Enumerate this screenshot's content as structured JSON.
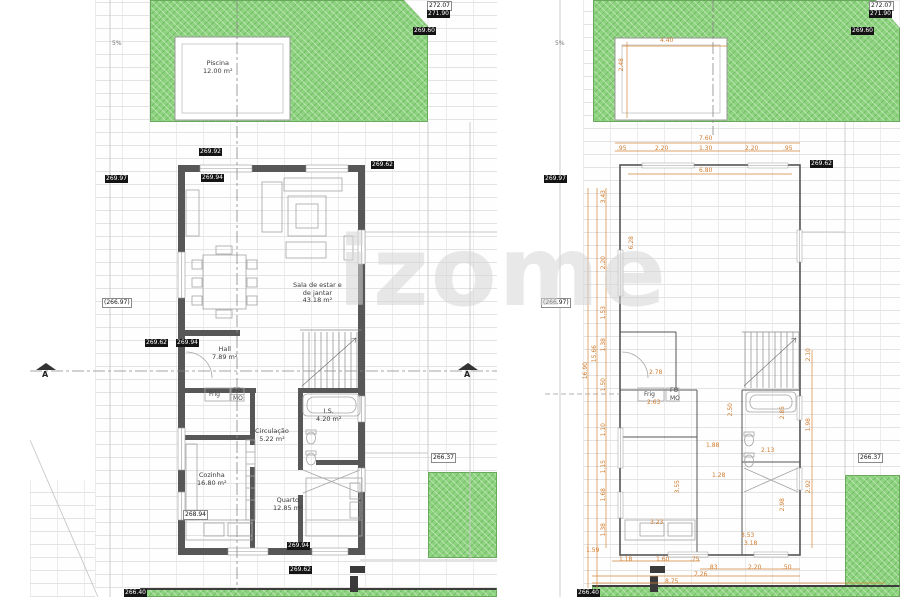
{
  "watermark": "izome",
  "colors": {
    "grass": "#8ed37f",
    "dimension": "#d07c2e",
    "wall": "#575757"
  },
  "section_marker": {
    "label": "A"
  },
  "slope_markers": [
    {
      "text": "5%",
      "x": 112,
      "y": 40
    },
    {
      "text": "5%",
      "x": 555,
      "y": 40
    }
  ],
  "left_plan": {
    "rooms": [
      {
        "text": "Piscina\n12.00 m²",
        "x": 203,
        "y": 60
      },
      {
        "text": "Sala de estar e\nde jantar\n43.18 m²",
        "x": 293,
        "y": 282
      },
      {
        "text": "Hall\n7.89 m²",
        "x": 212,
        "y": 346
      },
      {
        "text": "I.S.\n4.20 m²",
        "x": 316,
        "y": 408
      },
      {
        "text": "Circulação\n5.22 m²",
        "x": 255,
        "y": 428
      },
      {
        "text": "Cozinha\n16.80 m²",
        "x": 197,
        "y": 472
      },
      {
        "text": "Quarto\n12.85 m²",
        "x": 273,
        "y": 497
      }
    ],
    "appliances": [
      {
        "text": "Frig",
        "x": 209,
        "y": 391
      },
      {
        "text": "FO",
        "x": 233,
        "y": 387
      },
      {
        "text": "MO",
        "x": 233,
        "y": 395
      }
    ],
    "levels": [
      {
        "text": "272.07",
        "cls": "light",
        "x": 427,
        "y": 1
      },
      {
        "text": "271.90",
        "cls": "dark",
        "x": 427,
        "y": 10
      },
      {
        "text": "269.60",
        "cls": "dark",
        "x": 413,
        "y": 27
      },
      {
        "text": "269.92",
        "cls": "dark",
        "x": 199,
        "y": 148
      },
      {
        "text": "269.62",
        "cls": "dark",
        "x": 371,
        "y": 161
      },
      {
        "text": "269.94",
        "cls": "dark",
        "x": 201,
        "y": 174
      },
      {
        "text": "269.97",
        "cls": "dark",
        "x": 105,
        "y": 175
      },
      {
        "text": "(266.97)",
        "cls": "light",
        "x": 102,
        "y": 298
      },
      {
        "text": "269.62",
        "cls": "dark",
        "x": 145,
        "y": 339
      },
      {
        "text": "269.94",
        "cls": "dark",
        "x": 176,
        "y": 339
      },
      {
        "text": "268.94",
        "cls": "light",
        "x": 183,
        "y": 510
      },
      {
        "text": "266.37",
        "cls": "light",
        "x": 431,
        "y": 453
      },
      {
        "text": "269.94",
        "cls": "dark",
        "x": 287,
        "y": 542
      },
      {
        "text": "269.62",
        "cls": "dark",
        "x": 289,
        "y": 566
      },
      {
        "text": "266.40",
        "cls": "dark",
        "x": 124,
        "y": 589
      }
    ]
  },
  "right_plan": {
    "appliances": [
      {
        "text": "Frig",
        "x": 644,
        "y": 391
      },
      {
        "text": "FO",
        "x": 670,
        "y": 387
      },
      {
        "text": "MO",
        "x": 670,
        "y": 395
      }
    ],
    "levels": [
      {
        "text": "272.07",
        "cls": "light",
        "x": 869,
        "y": 1
      },
      {
        "text": "271.90",
        "cls": "dark",
        "x": 869,
        "y": 10
      },
      {
        "text": "269.60",
        "cls": "dark",
        "x": 851,
        "y": 27
      },
      {
        "text": "269.62",
        "cls": "dark",
        "x": 810,
        "y": 160
      },
      {
        "text": "269.97",
        "cls": "dark",
        "x": 544,
        "y": 175
      },
      {
        "text": "(266.97)",
        "cls": "light",
        "x": 541,
        "y": 298
      },
      {
        "text": "266.37",
        "cls": "light",
        "x": 858,
        "y": 453
      },
      {
        "text": "266.40",
        "cls": "dark",
        "x": 577,
        "y": 589
      }
    ],
    "dimensions": [
      {
        "text": "4.40",
        "x": 660,
        "y": 38
      },
      {
        "text": "2.48",
        "x": 619,
        "y": 58,
        "cls": "vrot"
      },
      {
        "text": "7.60",
        "x": 699,
        "y": 136
      },
      {
        "text": ".95",
        "x": 617,
        "y": 146
      },
      {
        "text": "2.20",
        "x": 655,
        "y": 146
      },
      {
        "text": "1.30",
        "x": 699,
        "y": 146
      },
      {
        "text": "2.20",
        "x": 745,
        "y": 146
      },
      {
        "text": ".95",
        "x": 783,
        "y": 146
      },
      {
        "text": "6.80",
        "x": 699,
        "y": 168
      },
      {
        "text": "3.43",
        "x": 601,
        "y": 190,
        "cls": "vrot"
      },
      {
        "text": "2.20",
        "x": 601,
        "y": 256,
        "cls": "vrot"
      },
      {
        "text": "1.53",
        "x": 601,
        "y": 306,
        "cls": "vrot"
      },
      {
        "text": "1.38",
        "x": 601,
        "y": 338,
        "cls": "vrot"
      },
      {
        "text": "1.50",
        "x": 601,
        "y": 378,
        "cls": "vrot"
      },
      {
        "text": "1.10",
        "x": 601,
        "y": 423,
        "cls": "vrot"
      },
      {
        "text": "1.15",
        "x": 601,
        "y": 460,
        "cls": "vrot"
      },
      {
        "text": "1.68",
        "x": 601,
        "y": 488,
        "cls": "vrot"
      },
      {
        "text": "1.38",
        "x": 601,
        "y": 523,
        "cls": "vrot"
      },
      {
        "text": "15.66",
        "x": 592,
        "y": 345,
        "cls": "vrot"
      },
      {
        "text": "16.90",
        "x": 583,
        "y": 362,
        "cls": "vrot"
      },
      {
        "text": "6.28",
        "x": 629,
        "y": 236,
        "cls": "vrot"
      },
      {
        "text": "2.78",
        "x": 649,
        "y": 370
      },
      {
        "text": "2.63",
        "x": 647,
        "y": 400
      },
      {
        "text": "2.50",
        "x": 728,
        "y": 403,
        "cls": "vrot"
      },
      {
        "text": "2.85",
        "x": 780,
        "y": 406,
        "cls": "vrot"
      },
      {
        "text": "1.88",
        "x": 706,
        "y": 443
      },
      {
        "text": "2.13",
        "x": 761,
        "y": 448
      },
      {
        "text": "1.28",
        "x": 712,
        "y": 473
      },
      {
        "text": "3.55",
        "x": 675,
        "y": 480,
        "cls": "vrot"
      },
      {
        "text": "2.98",
        "x": 780,
        "y": 498,
        "cls": "vrot"
      },
      {
        "text": "3.23",
        "x": 650,
        "y": 520
      },
      {
        "text": "3.53",
        "x": 741,
        "y": 533
      },
      {
        "text": "3.18",
        "x": 744,
        "y": 541
      },
      {
        "text": "2.10",
        "x": 806,
        "y": 348,
        "cls": "vrot"
      },
      {
        "text": "1.98",
        "x": 806,
        "y": 418,
        "cls": "vrot"
      },
      {
        "text": "2.92",
        "x": 806,
        "y": 480,
        "cls": "vrot"
      },
      {
        "text": "1.59",
        "x": 586,
        "y": 548
      },
      {
        "text": "1.18",
        "x": 619,
        "y": 557
      },
      {
        "text": "1.60",
        "x": 656,
        "y": 557
      },
      {
        "text": ".75",
        "x": 690,
        "y": 557
      },
      {
        "text": ".83",
        "x": 708,
        "y": 565
      },
      {
        "text": "2.20",
        "x": 748,
        "y": 565
      },
      {
        "text": ".50",
        "x": 782,
        "y": 565
      },
      {
        "text": "7.26",
        "x": 694,
        "y": 572
      },
      {
        "text": "8.75",
        "x": 665,
        "y": 579
      }
    ]
  }
}
